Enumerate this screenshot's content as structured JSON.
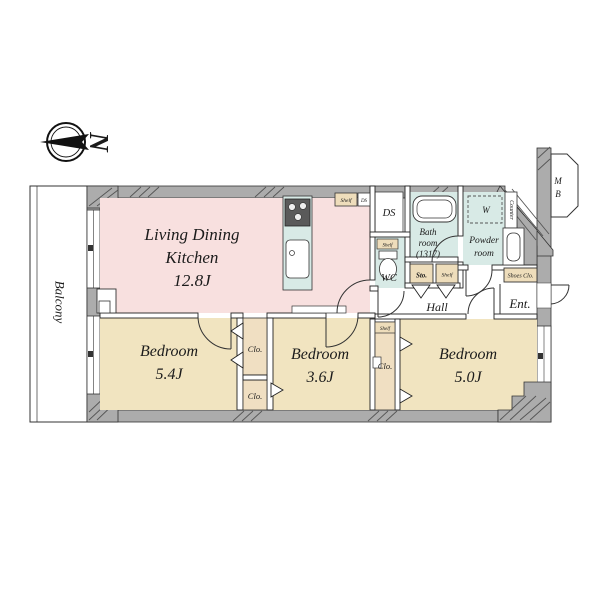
{
  "colors": {
    "ldk_pink": "#f8e0df",
    "bedroom_tan": "#f1e4c0",
    "wet_cyan": "#d8eae6",
    "closet_tan": "#f0dfc2",
    "label_tan": "#eeddbb",
    "wall_gray": "#acacac"
  },
  "compass": {
    "north_letter": "N"
  },
  "balcony": {
    "label": "Balcony"
  },
  "rooms": {
    "ldk": {
      "line1": "Living Dining",
      "line2": "Kitchen",
      "size": "12.8J"
    },
    "bedroom_54": {
      "name": "Bedroom",
      "size": "5.4J"
    },
    "bedroom_36": {
      "name": "Bedroom",
      "size": "3.6J"
    },
    "bedroom_50": {
      "name": "Bedroom",
      "size": "5.0J"
    },
    "bath": {
      "line1": "Bath",
      "line2": "room",
      "line3": "(1317)"
    },
    "wc": {
      "label": "WC"
    },
    "powder": {
      "line1": "Powder",
      "line2": "room"
    },
    "hall": {
      "label": "Hall"
    },
    "entrance": {
      "label": "Ent."
    },
    "ds": {
      "label": "DS"
    }
  },
  "labels": {
    "shelf_kitchen": "Shelf",
    "ds_duct": "DS",
    "shelf_wc": "Shelf",
    "sto": "Sto.",
    "shelf_hall": "Shelf",
    "shelf_closet": "Shelf",
    "closet_upper": "Clo.",
    "closet_lower": "Clo.",
    "closet_b3": "Clo.",
    "shoes_closet": "Shoes Clo.",
    "washer": "W",
    "counter": "Counter",
    "meter_box_m": "M",
    "meter_box_b": "B"
  }
}
